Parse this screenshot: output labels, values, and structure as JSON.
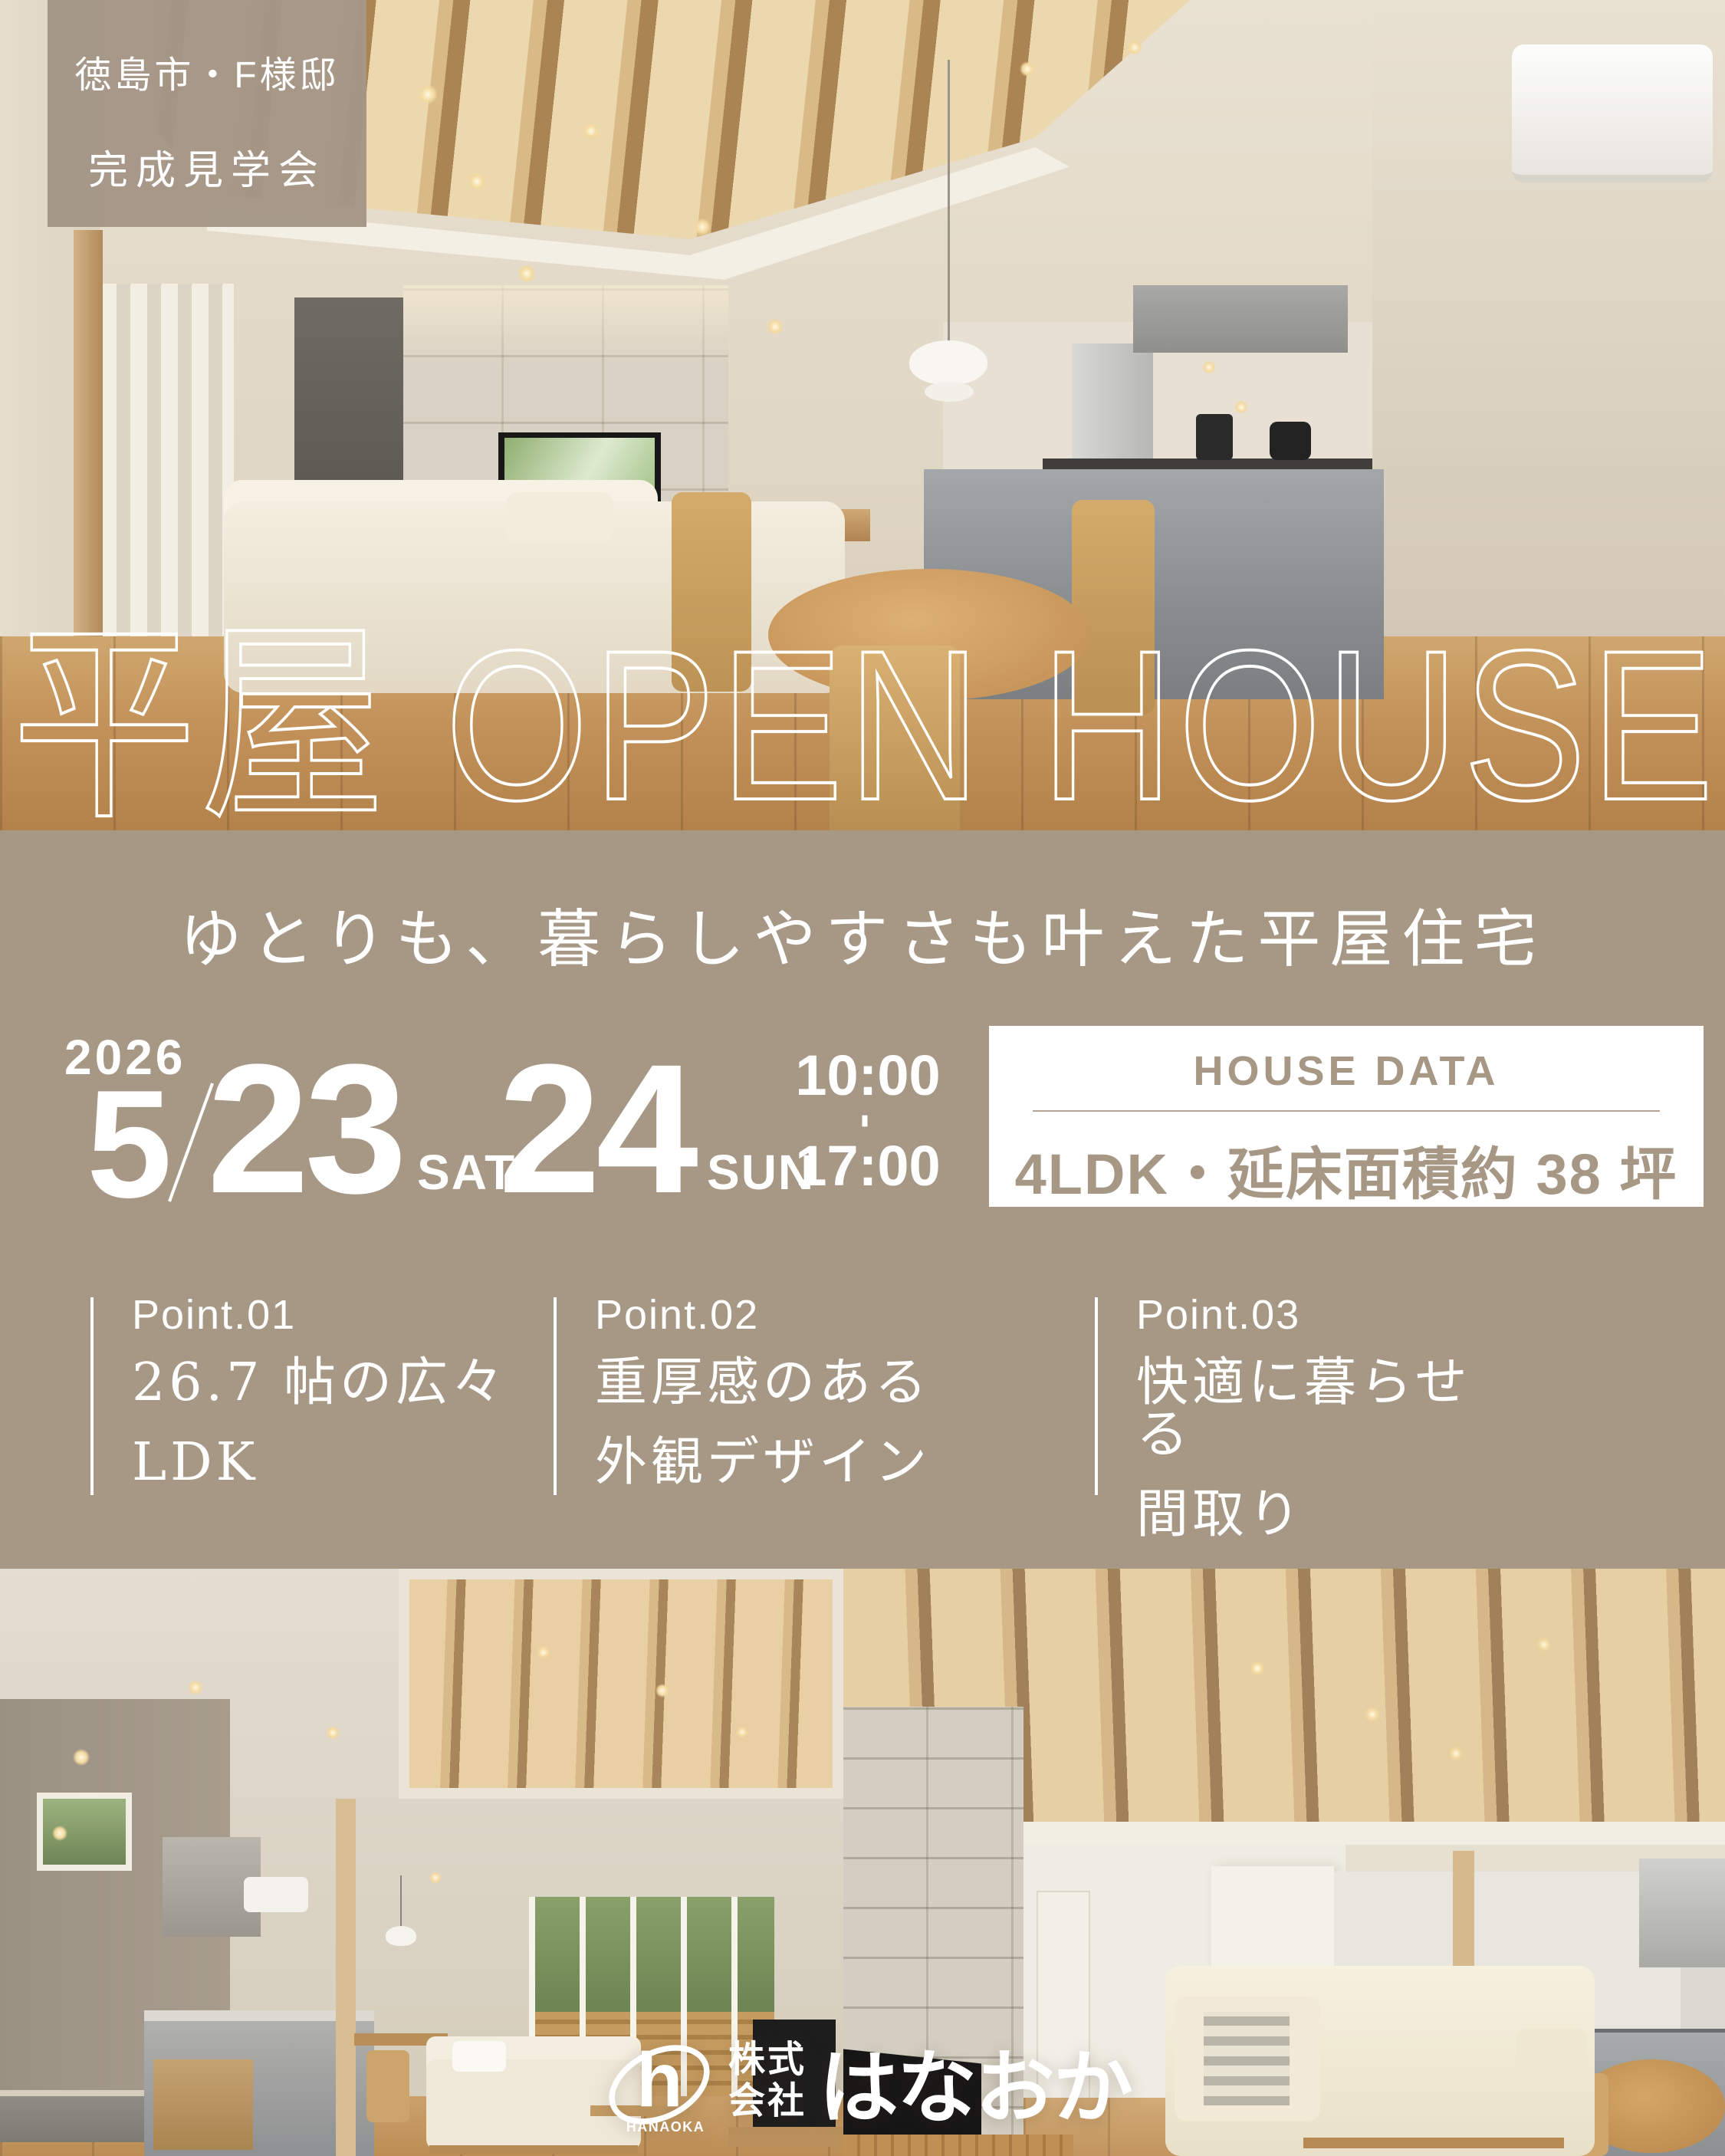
{
  "colors": {
    "background_taupe": "#a79886",
    "text_white": "#ffffff",
    "card_background": "#ffffff",
    "card_text_taupe": "#a79886"
  },
  "badge": {
    "line1": "徳島市・F様邸",
    "line2": "完成見学会"
  },
  "title": {
    "text": "平屋 OPEN HOUSE"
  },
  "subtitle": {
    "text": "ゆとりも、暮らしやすさも叶えた平屋住宅"
  },
  "event": {
    "year": "2026",
    "month": "5",
    "day1": "23",
    "day1_dow": "SAT",
    "day2": "24",
    "day2_dow": "SUN",
    "time_start": "10:00",
    "time_separator": "-",
    "time_end": "17:00"
  },
  "house_data": {
    "heading": "HOUSE DATA",
    "value": "4LDK・延床面積約 38 坪"
  },
  "points": [
    {
      "label": "Point.01",
      "line1": "26.7 帖の広々",
      "line2": "LDK"
    },
    {
      "label": "Point.02",
      "line1": "重厚感のある",
      "line2": "外観デザイン"
    },
    {
      "label": "Point.03",
      "line1": "快適に暮らせる",
      "line2": "間取り"
    }
  ],
  "logo": {
    "mark_letter": "h",
    "mark_caption": "HANAOKA",
    "company_line1": "株式",
    "company_line2": "会社",
    "name": "はなおか"
  }
}
